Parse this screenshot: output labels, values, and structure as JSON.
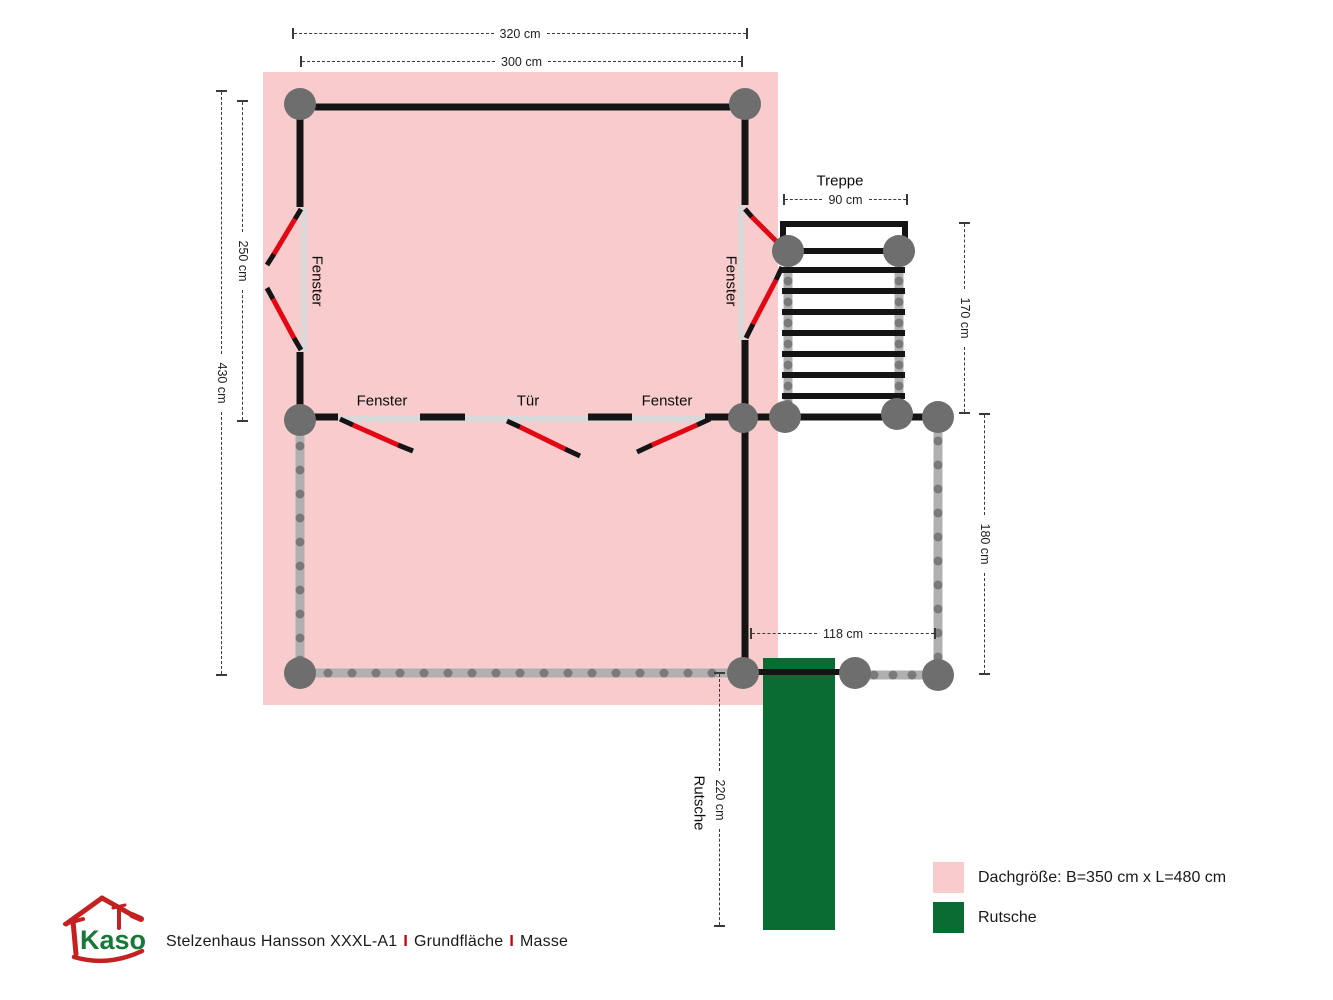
{
  "diagram": {
    "dimensions": {
      "d320": "320 cm",
      "d300": "300 cm",
      "d250": "250 cm",
      "d430": "430 cm",
      "d90": "90 cm",
      "d170": "170 cm",
      "d180": "180 cm",
      "d118": "118 cm",
      "d220": "220 cm"
    },
    "labels": {
      "treppe": "Treppe",
      "fenster_left": "Fenster",
      "fenster_right": "Fenster",
      "fenster_bottom_left": "Fenster",
      "tuer": "Tür",
      "fenster_bottom_right": "Fenster",
      "rutsche": "Rutsche"
    },
    "colors": {
      "roof_pink": "#f8cbcd",
      "slide_green": "#0a6b33",
      "swing_red": "#e30613",
      "post_gray": "#6e6e6e",
      "rail_gray": "#b0b0b0",
      "wall_black": "#141414"
    }
  },
  "legend": {
    "items": [
      {
        "swatch": "#f8cbcd",
        "label": "Dachgröße: B=350 cm x L=480 cm"
      },
      {
        "swatch": "#0a6b33",
        "label": "Rutsche"
      }
    ]
  },
  "footer": {
    "logo_text": "Kaso",
    "title_product": "Stelzenhaus Hansson XXXL-A1",
    "separator": "I",
    "title_section1": "Grundfläche",
    "title_section2": "Masse"
  }
}
